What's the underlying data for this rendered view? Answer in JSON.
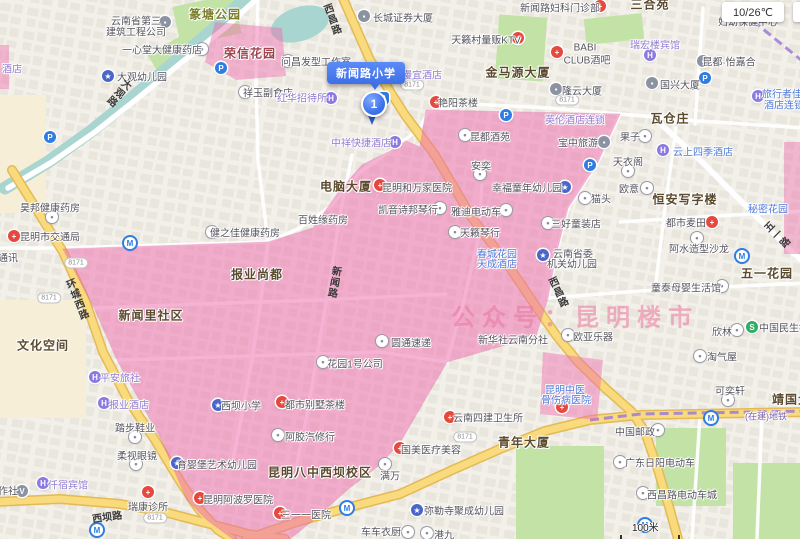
{
  "marker": {
    "title": "新闻路小学",
    "index": "1"
  },
  "weather": "10/26℃",
  "watermark": "公众号：昆明楼市",
  "scale": {
    "text": "100米"
  },
  "pill_text": "8171",
  "colors": {
    "district_pink": "#ee6fae",
    "road_yellow": "#f9da7c",
    "water": "#a8d5cf",
    "park_green": "#c2e3a5",
    "marker_blue": "#3f74ee"
  },
  "icon_glyphs": {
    "dot": "•",
    "cross": "+",
    "P": "P",
    "M": "M",
    "H": "H",
    "sch": "★",
    "bld": "▪",
    "V": "V",
    "S": "S",
    "bus": "B"
  },
  "labels": [
    {
      "t": "篆塘公园",
      "x": 215,
      "y": 14,
      "c": "bg"
    },
    {
      "t": "荣信花园",
      "x": 250,
      "y": 53,
      "c": "br"
    },
    {
      "t": "三合苑",
      "x": 650,
      "y": 4,
      "c": "b"
    },
    {
      "t": "金马源大厦",
      "x": 518,
      "y": 72,
      "c": "b"
    },
    {
      "t": "瓦仓庄",
      "x": 670,
      "y": 118,
      "c": "b"
    },
    {
      "t": "电脑大厦",
      "x": 346,
      "y": 186,
      "c": "b"
    },
    {
      "t": "恒安写字楼",
      "x": 685,
      "y": 199,
      "c": "b"
    },
    {
      "t": "报业尚都",
      "x": 257,
      "y": 274,
      "c": "b"
    },
    {
      "t": "新闻里社区",
      "x": 151,
      "y": 315,
      "c": "b"
    },
    {
      "t": "文化空间",
      "x": 43,
      "y": 345,
      "c": "b"
    },
    {
      "t": "五一花园",
      "x": 767,
      "y": 273,
      "c": "b"
    },
    {
      "t": "昆明八中西坝校区",
      "x": 320,
      "y": 472,
      "c": "b"
    },
    {
      "t": "青年大厦",
      "x": 524,
      "y": 442,
      "c": "b"
    },
    {
      "t": "靖国大厦",
      "x": 798,
      "y": 399,
      "c": "b"
    },
    {
      "t": "云南省第三",
      "x": 136,
      "y": 20,
      "c": "p"
    },
    {
      "t": "建筑工程公司",
      "x": 136,
      "y": 31,
      "c": "p"
    },
    {
      "t": "一心堂大健康药店",
      "x": 162,
      "y": 49,
      "c": "p"
    },
    {
      "t": "大观幼儿园",
      "x": 142,
      "y": 76,
      "c": "p"
    },
    {
      "t": "祥玉副食店",
      "x": 268,
      "y": 92,
      "c": "p"
    },
    {
      "t": "问昌发型工作室",
      "x": 316,
      "y": 61,
      "c": "p"
    },
    {
      "t": "长城证券大厦",
      "x": 403,
      "y": 17,
      "c": "p"
    },
    {
      "t": "天籁村量贩KTV",
      "x": 486,
      "y": 39,
      "c": "p"
    },
    {
      "t": "新闻路妇科门诊部",
      "x": 560,
      "y": 7,
      "c": "p"
    },
    {
      "t": "妇幼保健中心",
      "x": 748,
      "y": 21,
      "c": "p"
    },
    {
      "t": "BABI",
      "x": 585,
      "y": 48,
      "c": "p"
    },
    {
      "t": "CLUB酒吧",
      "x": 587,
      "y": 59,
      "c": "p"
    },
    {
      "t": "昆都·怡嘉合",
      "x": 729,
      "y": 61,
      "c": "p"
    },
    {
      "t": "隆云大厦",
      "x": 582,
      "y": 90,
      "c": "p"
    },
    {
      "t": "国兴大厦",
      "x": 680,
      "y": 84,
      "c": "p"
    },
    {
      "t": "昊邦健康药房",
      "x": 50,
      "y": 207,
      "c": "p"
    },
    {
      "t": "昆明市交通局",
      "x": 50,
      "y": 236,
      "c": "p"
    },
    {
      "t": "健之佳健康药房",
      "x": 245,
      "y": 232,
      "c": "p"
    },
    {
      "t": "通讯",
      "x": 8,
      "y": 257,
      "c": "p"
    },
    {
      "t": "昆明和万家医院",
      "x": 417,
      "y": 187,
      "c": "p"
    },
    {
      "t": "凯音诗邦琴行",
      "x": 408,
      "y": 209,
      "c": "p"
    },
    {
      "t": "雅迪电动车",
      "x": 476,
      "y": 211,
      "c": "p"
    },
    {
      "t": "百姓缘药房",
      "x": 323,
      "y": 219,
      "c": "p"
    },
    {
      "t": "天籁琴行",
      "x": 480,
      "y": 232,
      "c": "p"
    },
    {
      "t": "幸福童年幼儿园",
      "x": 527,
      "y": 187,
      "c": "p"
    },
    {
      "t": "昆都酒苑",
      "x": 490,
      "y": 136,
      "c": "p"
    },
    {
      "t": "安奕",
      "x": 481,
      "y": 165,
      "c": "p"
    },
    {
      "t": "艳阳茶楼",
      "x": 458,
      "y": 102,
      "c": "p"
    },
    {
      "t": "欧意",
      "x": 629,
      "y": 188,
      "c": "p"
    },
    {
      "t": "猫头",
      "x": 601,
      "y": 198,
      "c": "p"
    },
    {
      "t": "三好童装店",
      "x": 576,
      "y": 223,
      "c": "p"
    },
    {
      "t": "都市麦田",
      "x": 686,
      "y": 222,
      "c": "p"
    },
    {
      "t": "阿水造型沙龙",
      "x": 699,
      "y": 248,
      "c": "p"
    },
    {
      "t": "云南省委",
      "x": 573,
      "y": 253,
      "c": "p"
    },
    {
      "t": "机关幼儿园",
      "x": 572,
      "y": 263,
      "c": "p"
    },
    {
      "t": "童泰母婴生活馆",
      "x": 686,
      "y": 287,
      "c": "p"
    },
    {
      "t": "欧亚乐器",
      "x": 593,
      "y": 336,
      "c": "p"
    },
    {
      "t": "新华社云南分社",
      "x": 513,
      "y": 339,
      "c": "p"
    },
    {
      "t": "欣林",
      "x": 722,
      "y": 331,
      "c": "p"
    },
    {
      "t": "中国民生银行",
      "x": 789,
      "y": 327,
      "c": "p"
    },
    {
      "t": "淘气屋",
      "x": 722,
      "y": 356,
      "c": "p"
    },
    {
      "t": "果子",
      "x": 630,
      "y": 136,
      "c": "p"
    },
    {
      "t": "天衣阁",
      "x": 628,
      "y": 161,
      "c": "p"
    },
    {
      "t": "宝中旅游",
      "x": 578,
      "y": 142,
      "c": "p"
    },
    {
      "t": "花园1号公司",
      "x": 355,
      "y": 363,
      "c": "p"
    },
    {
      "t": "圆通速递",
      "x": 411,
      "y": 342,
      "c": "p"
    },
    {
      "t": "都市别墅茶楼",
      "x": 315,
      "y": 404,
      "c": "p"
    },
    {
      "t": "阿胶汽修行",
      "x": 310,
      "y": 436,
      "c": "p"
    },
    {
      "t": "国美医疗美容",
      "x": 431,
      "y": 449,
      "c": "p"
    },
    {
      "t": "满万",
      "x": 390,
      "y": 475,
      "c": "p"
    },
    {
      "t": "云南四建卫生所",
      "x": 488,
      "y": 417,
      "c": "p"
    },
    {
      "t": "三一一医院",
      "x": 306,
      "y": 514,
      "c": "p"
    },
    {
      "t": "弥勒寺聚成幼儿园",
      "x": 464,
      "y": 510,
      "c": "p"
    },
    {
      "t": "车车衣厨",
      "x": 381,
      "y": 531,
      "c": "p"
    },
    {
      "t": "港九",
      "x": 444,
      "y": 534,
      "c": "p"
    },
    {
      "t": "可奕轩",
      "x": 730,
      "y": 390,
      "c": "p"
    },
    {
      "t": "中国邮政",
      "x": 635,
      "y": 431,
      "c": "p"
    },
    {
      "t": "广东日阳电动车",
      "x": 660,
      "y": 462,
      "c": "p"
    },
    {
      "t": "西昌路电动车城",
      "x": 682,
      "y": 494,
      "c": "p"
    },
    {
      "t": "西坝小学",
      "x": 241,
      "y": 405,
      "c": "p"
    },
    {
      "t": "育婴堡艺术幼儿园",
      "x": 217,
      "y": 464,
      "c": "p"
    },
    {
      "t": "昆明阿波罗医院",
      "x": 238,
      "y": 499,
      "c": "p"
    },
    {
      "t": "瑞康诊所",
      "x": 148,
      "y": 506,
      "c": "p"
    },
    {
      "t": "踏步鞋业",
      "x": 135,
      "y": 427,
      "c": "p"
    },
    {
      "t": "柔视眼镜",
      "x": 137,
      "y": 455,
      "c": "p"
    },
    {
      "t": "作社",
      "x": 8,
      "y": 490,
      "c": "p"
    },
    {
      "t": "平安旅社",
      "x": 120,
      "y": 377,
      "c": "pu"
    },
    {
      "t": "报业酒店",
      "x": 129,
      "y": 404,
      "c": "pu"
    },
    {
      "t": "仟宿宾馆",
      "x": 68,
      "y": 484,
      "c": "pu"
    },
    {
      "t": "红华招待所",
      "x": 302,
      "y": 97,
      "c": "pu"
    },
    {
      "t": "中祥快捷酒店",
      "x": 361,
      "y": 142,
      "c": "pu"
    },
    {
      "t": "漫宜酒店",
      "x": 422,
      "y": 74,
      "c": "pu"
    },
    {
      "t": "瑞宏楼宾馆",
      "x": 655,
      "y": 44,
      "c": "pu"
    },
    {
      "t": "英伦酒店连锁",
      "x": 575,
      "y": 119,
      "c": "pu"
    },
    {
      "t": "酒店",
      "x": 12,
      "y": 68,
      "c": "pu"
    },
    {
      "t": "云上四季酒店",
      "x": 703,
      "y": 151,
      "c": "bl"
    },
    {
      "t": "旅行者佳",
      "x": 782,
      "y": 93,
      "c": "bl"
    },
    {
      "t": "酒店连锁",
      "x": 784,
      "y": 104,
      "c": "bl"
    },
    {
      "t": "秘密花园",
      "x": 768,
      "y": 208,
      "c": "bl"
    },
    {
      "t": "春城花园",
      "x": 497,
      "y": 253,
      "c": "bl"
    },
    {
      "t": "天成酒店",
      "x": 497,
      "y": 263,
      "c": "bl"
    },
    {
      "t": "昆明中医",
      "x": 565,
      "y": 389,
      "c": "bl"
    },
    {
      "t": "骨伤病医院",
      "x": 566,
      "y": 399,
      "c": "bl"
    },
    {
      "t": "西昌路",
      "x": 331,
      "y": 20,
      "c": "rd",
      "v": true,
      "r": -20
    },
    {
      "t": "西昌路",
      "x": 557,
      "y": 293,
      "c": "rd",
      "v": true,
      "r": -25
    },
    {
      "t": "环城西路",
      "x": 76,
      "y": 300,
      "c": "rd",
      "v": true,
      "r": -22
    },
    {
      "t": "大观路",
      "x": 118,
      "y": 92,
      "c": "rd",
      "v": true,
      "r": 40
    },
    {
      "t": "西坝路",
      "x": 107,
      "y": 516,
      "c": "rd",
      "r": -8
    },
    {
      "t": "新闻路",
      "x": 333,
      "y": 282,
      "c": "rd",
      "v": true,
      "r": 10
    },
    {
      "t": "五一路",
      "x": 776,
      "y": 236,
      "c": "rd",
      "v": true,
      "r": -45
    },
    {
      "t": "(在建)地铁",
      "x": 766,
      "y": 416,
      "c": "sub"
    }
  ],
  "icons": [
    {
      "k": "dot",
      "x": 52,
      "y": 217
    },
    {
      "k": "dot",
      "x": 212,
      "y": 232
    },
    {
      "k": "dot",
      "x": 288,
      "y": 61
    },
    {
      "k": "dot",
      "x": 245,
      "y": 92
    },
    {
      "k": "dot",
      "x": 202,
      "y": 49
    },
    {
      "k": "dot",
      "x": 135,
      "y": 437
    },
    {
      "k": "dot",
      "x": 136,
      "y": 464
    },
    {
      "k": "dot",
      "x": 647,
      "y": 188
    },
    {
      "k": "dot",
      "x": 585,
      "y": 198
    },
    {
      "k": "dot",
      "x": 548,
      "y": 223
    },
    {
      "k": "dot",
      "x": 440,
      "y": 208
    },
    {
      "k": "dot",
      "x": 506,
      "y": 210
    },
    {
      "k": "dot",
      "x": 455,
      "y": 232
    },
    {
      "k": "dot",
      "x": 465,
      "y": 135
    },
    {
      "k": "dot",
      "x": 480,
      "y": 174
    },
    {
      "k": "dot",
      "x": 628,
      "y": 171
    },
    {
      "k": "dot",
      "x": 645,
      "y": 136
    },
    {
      "k": "dot",
      "x": 697,
      "y": 238
    },
    {
      "k": "dot",
      "x": 722,
      "y": 286
    },
    {
      "k": "dot",
      "x": 568,
      "y": 335
    },
    {
      "k": "dot",
      "x": 737,
      "y": 330
    },
    {
      "k": "dot",
      "x": 700,
      "y": 356
    },
    {
      "k": "dot",
      "x": 323,
      "y": 362
    },
    {
      "k": "dot",
      "x": 382,
      "y": 341
    },
    {
      "k": "dot",
      "x": 278,
      "y": 435
    },
    {
      "k": "dot",
      "x": 385,
      "y": 464
    },
    {
      "k": "dot",
      "x": 728,
      "y": 400
    },
    {
      "k": "dot",
      "x": 658,
      "y": 430
    },
    {
      "k": "dot",
      "x": 620,
      "y": 462
    },
    {
      "k": "dot",
      "x": 643,
      "y": 493
    },
    {
      "k": "dot",
      "x": 408,
      "y": 532
    },
    {
      "k": "dot",
      "x": 427,
      "y": 533
    },
    {
      "k": "cross",
      "x": 14,
      "y": 236
    },
    {
      "k": "cross",
      "x": 380,
      "y": 185
    },
    {
      "k": "cross",
      "x": 436,
      "y": 102
    },
    {
      "k": "cross",
      "x": 712,
      "y": 222
    },
    {
      "k": "cross",
      "x": 600,
      "y": 6
    },
    {
      "k": "cross",
      "x": 557,
      "y": 52
    },
    {
      "k": "cross",
      "x": 400,
      "y": 448
    },
    {
      "k": "cross",
      "x": 450,
      "y": 417
    },
    {
      "k": "cross",
      "x": 148,
      "y": 492
    },
    {
      "k": "cross",
      "x": 200,
      "y": 498
    },
    {
      "k": "cross",
      "x": 280,
      "y": 513
    },
    {
      "k": "cross",
      "x": 562,
      "y": 407
    },
    {
      "k": "cross",
      "x": 282,
      "y": 402
    },
    {
      "k": "cross",
      "x": 518,
      "y": 38
    },
    {
      "k": "P",
      "x": 221,
      "y": 68
    },
    {
      "k": "P",
      "x": 705,
      "y": 78
    },
    {
      "k": "P",
      "x": 590,
      "y": 165
    },
    {
      "k": "P",
      "x": 506,
      "y": 115
    },
    {
      "k": "P",
      "x": 50,
      "y": 137
    },
    {
      "k": "M",
      "x": 130,
      "y": 243
    },
    {
      "k": "M",
      "x": 347,
      "y": 508
    },
    {
      "k": "M",
      "x": 742,
      "y": 256
    },
    {
      "k": "M",
      "x": 645,
      "y": 525
    },
    {
      "k": "M",
      "x": 711,
      "y": 418
    },
    {
      "k": "M",
      "x": 97,
      "y": 530
    },
    {
      "k": "H",
      "x": 95,
      "y": 377
    },
    {
      "k": "H",
      "x": 104,
      "y": 403
    },
    {
      "k": "H",
      "x": 43,
      "y": 483
    },
    {
      "k": "H",
      "x": 331,
      "y": 98
    },
    {
      "k": "H",
      "x": 395,
      "y": 142
    },
    {
      "k": "H",
      "x": 650,
      "y": 55
    },
    {
      "k": "H",
      "x": 663,
      "y": 150
    },
    {
      "k": "H",
      "x": 758,
      "y": 96
    },
    {
      "k": "H",
      "x": 415,
      "y": 84
    },
    {
      "k": "sch",
      "x": 108,
      "y": 76
    },
    {
      "k": "sch",
      "x": 218,
      "y": 405
    },
    {
      "k": "sch",
      "x": 177,
      "y": 463
    },
    {
      "k": "sch",
      "x": 565,
      "y": 187
    },
    {
      "k": "sch",
      "x": 543,
      "y": 255
    },
    {
      "k": "sch",
      "x": 417,
      "y": 510
    },
    {
      "k": "V",
      "x": 22,
      "y": 491
    },
    {
      "k": "S",
      "x": 752,
      "y": 327
    },
    {
      "k": "bus",
      "x": 383,
      "y": 98
    },
    {
      "k": "bld",
      "x": 364,
      "y": 16
    },
    {
      "k": "bld",
      "x": 165,
      "y": 22
    },
    {
      "k": "bld",
      "x": 556,
      "y": 89
    },
    {
      "k": "bld",
      "x": 652,
      "y": 83
    },
    {
      "k": "bld",
      "x": 703,
      "y": 61
    },
    {
      "k": "bld",
      "x": 604,
      "y": 142
    }
  ],
  "pills": [
    [
      412,
      85
    ],
    [
      76,
      263
    ],
    [
      49,
      298
    ],
    [
      567,
      100
    ],
    [
      155,
      518
    ],
    [
      465,
      437
    ]
  ]
}
